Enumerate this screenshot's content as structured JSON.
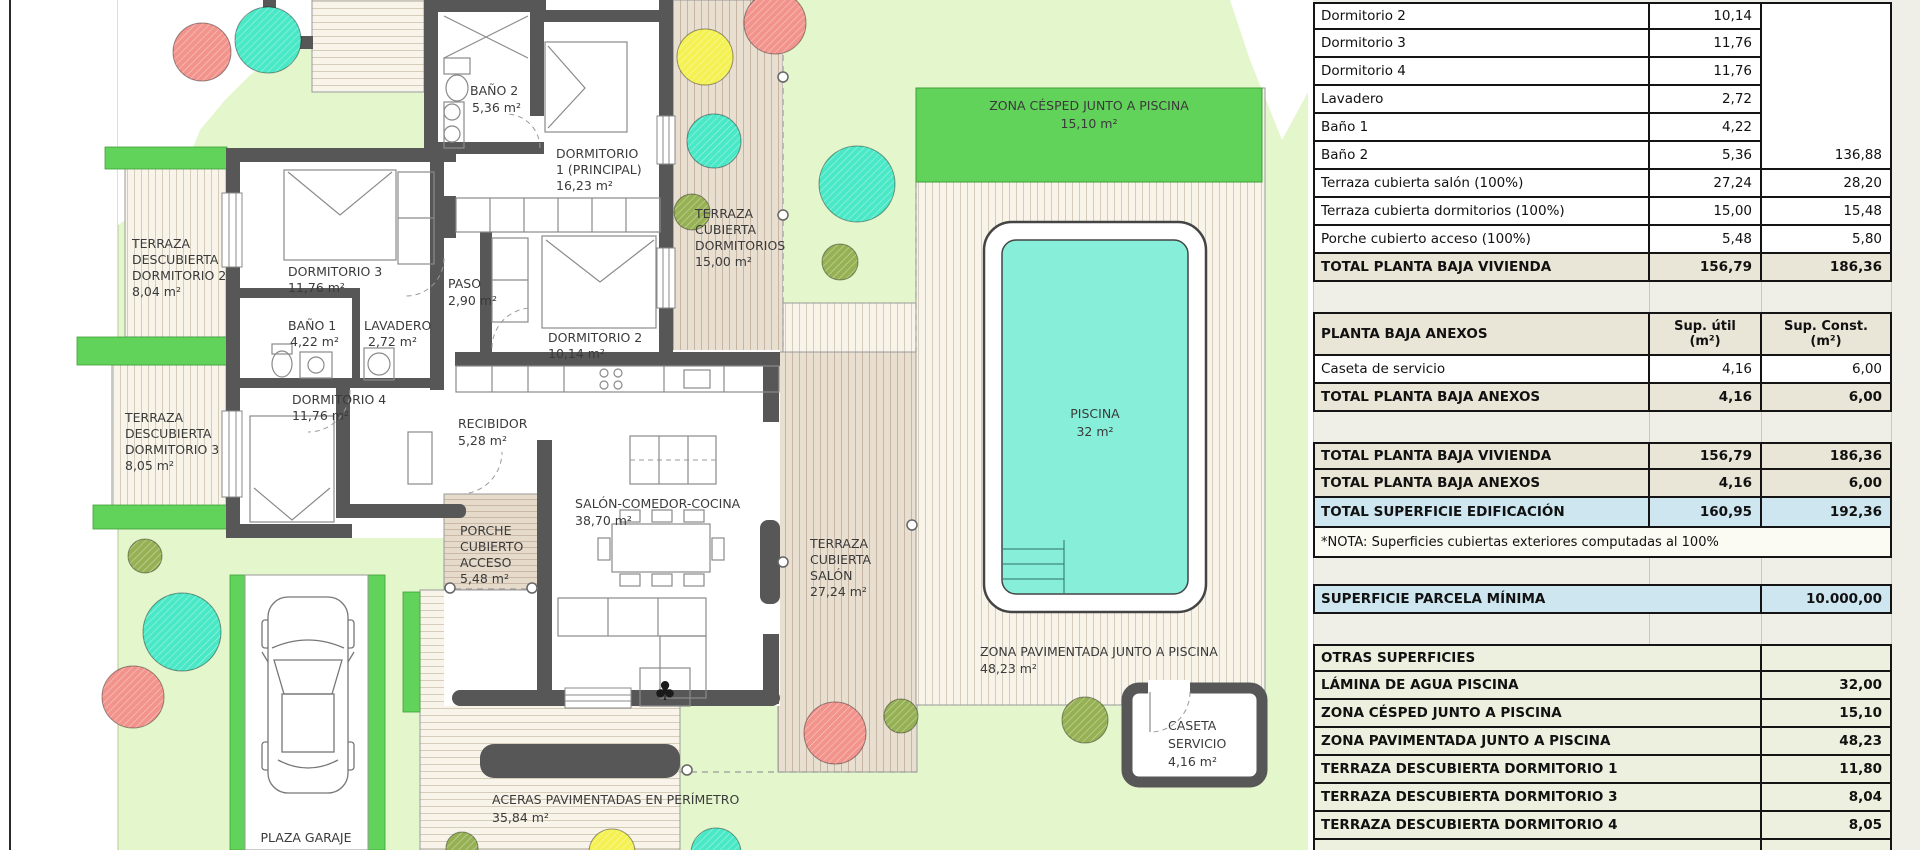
{
  "plan": {
    "labels": {
      "terraza_d2": [
        "TERRAZA",
        "DESCUBIERTA",
        "DORMITORIO 2",
        "8,04 m²"
      ],
      "terraza_d3": [
        "TERRAZA",
        "DESCUBIERTA",
        "DORMITORIO 3",
        "8,05 m²"
      ],
      "dorm3": [
        "DORMITORIO 3",
        "11,76 m²"
      ],
      "banyo1": [
        "BAÑO 1",
        "4,22 m²"
      ],
      "lavadero": [
        "LAVADERO",
        "2,72 m²"
      ],
      "dorm4": [
        "DORMITORIO 4",
        "11,76 m²"
      ],
      "banyo2": [
        "BAÑO 2",
        "5,36 m²"
      ],
      "dorm1": [
        "DORMITORIO",
        "1 (PRINCIPAL)",
        "16,23 m²"
      ],
      "paso": [
        "PASO",
        "2,90 m²"
      ],
      "dorm2": [
        "DORMITORIO 2",
        "10,14 m²"
      ],
      "recibidor": [
        "RECIBIDOR",
        "5,28 m²"
      ],
      "salon": [
        "SALÓN-COMEDOR-COCINA",
        "38,70 m²"
      ],
      "porche": [
        "PORCHE",
        "CUBIERTO",
        "ACCESO",
        "5,48 m²"
      ],
      "t_c_dorm": [
        "TERRAZA",
        "CUBIERTA",
        "DORMITORIOS",
        "15,00 m²"
      ],
      "t_c_salon": [
        "TERRAZA",
        "CUBIERTA",
        "SALÓN",
        "27,24 m²"
      ],
      "cesped": [
        "ZONA CÉSPED JUNTO A PISCINA",
        "15,10 m²"
      ],
      "piscina": [
        "PISCINA",
        "32 m²"
      ],
      "pavimentada": [
        "ZONA PAVIMENTADA JUNTO A PISCINA",
        "48,23 m²"
      ],
      "caseta": [
        "CASETA",
        "SERVICIO",
        "4,16 m²"
      ],
      "aceras": [
        "ACERAS PAVIMENTADAS EN PERÍMETRO",
        "35,84 m²"
      ],
      "plaza": [
        "PLAZA GARAJE",
        "DESCUBIERTA"
      ]
    }
  },
  "table": {
    "vivienda_rows": [
      [
        "Dormitorio 2",
        "10,14",
        ""
      ],
      [
        "Dormitorio 3",
        "11,76",
        ""
      ],
      [
        "Dormitorio 4",
        "11,76",
        ""
      ],
      [
        "Lavadero",
        "2,72",
        ""
      ],
      [
        "Baño 1",
        "4,22",
        ""
      ],
      [
        "Baño 2",
        "5,36",
        "136,88"
      ],
      [
        "Terraza cubierta salón (100%)",
        "27,24",
        "28,20"
      ],
      [
        "Terraza cubierta dormitorios (100%)",
        "15,00",
        "15,48"
      ],
      [
        "Porche cubierto acceso (100%)",
        "5,48",
        "5,80"
      ]
    ],
    "total_vivienda": [
      "TOTAL PLANTA BAJA VIVIENDA",
      "156,79",
      "186,36"
    ],
    "anexos_header": [
      "PLANTA BAJA ANEXOS",
      "Sup. útil\n(m²)",
      "Sup. Const.\n(m²)"
    ],
    "anexos_rows": [
      [
        "Caseta de servicio",
        "4,16",
        "6,00"
      ]
    ],
    "total_anexos": [
      "TOTAL PLANTA BAJA ANEXOS",
      "4,16",
      "6,00"
    ],
    "summary_rows": [
      [
        "TOTAL PLANTA BAJA VIVIENDA",
        "156,79",
        "186,36"
      ],
      [
        "TOTAL PLANTA BAJA ANEXOS",
        "4,16",
        "6,00"
      ],
      [
        "TOTAL SUPERFICIE EDIFICACIÓN",
        "160,95",
        "192,36"
      ]
    ],
    "nota": "*NOTA: Superficies cubiertas exteriores computadas al 100%",
    "parcela": [
      "SUPERFICIE PARCELA MÍNIMA",
      "10.000,00"
    ],
    "otras_header": "OTRAS SUPERFICIES",
    "otras_rows": [
      [
        "LÁMINA DE AGUA PISCINA",
        "32,00"
      ],
      [
        "ZONA CÉSPED JUNTO A PISCINA",
        "15,10"
      ],
      [
        "ZONA PAVIMENTADA JUNTO A PISCINA",
        "48,23"
      ],
      [
        "TERRAZA DESCUBIERTA DORMITORIO 1",
        "11,80"
      ],
      [
        "TERRAZA DESCUBIERTA DORMITORIO 3",
        "8,04"
      ],
      [
        "TERRAZA DESCUBIERTA DORMITORIO 4",
        "8,05"
      ]
    ]
  },
  "colors": {
    "garden": "#e4f6cc",
    "hedge": "#62d35a",
    "pool_water": "#87efd9",
    "wall": "#575757",
    "table_beige": "#e9e5d7",
    "table_blue": "#cde6f0",
    "tree_coral": "#f2938c",
    "tree_turquoise": "#49e8c6",
    "tree_yellow": "#f4f153",
    "tree_olive": "#96b153"
  }
}
